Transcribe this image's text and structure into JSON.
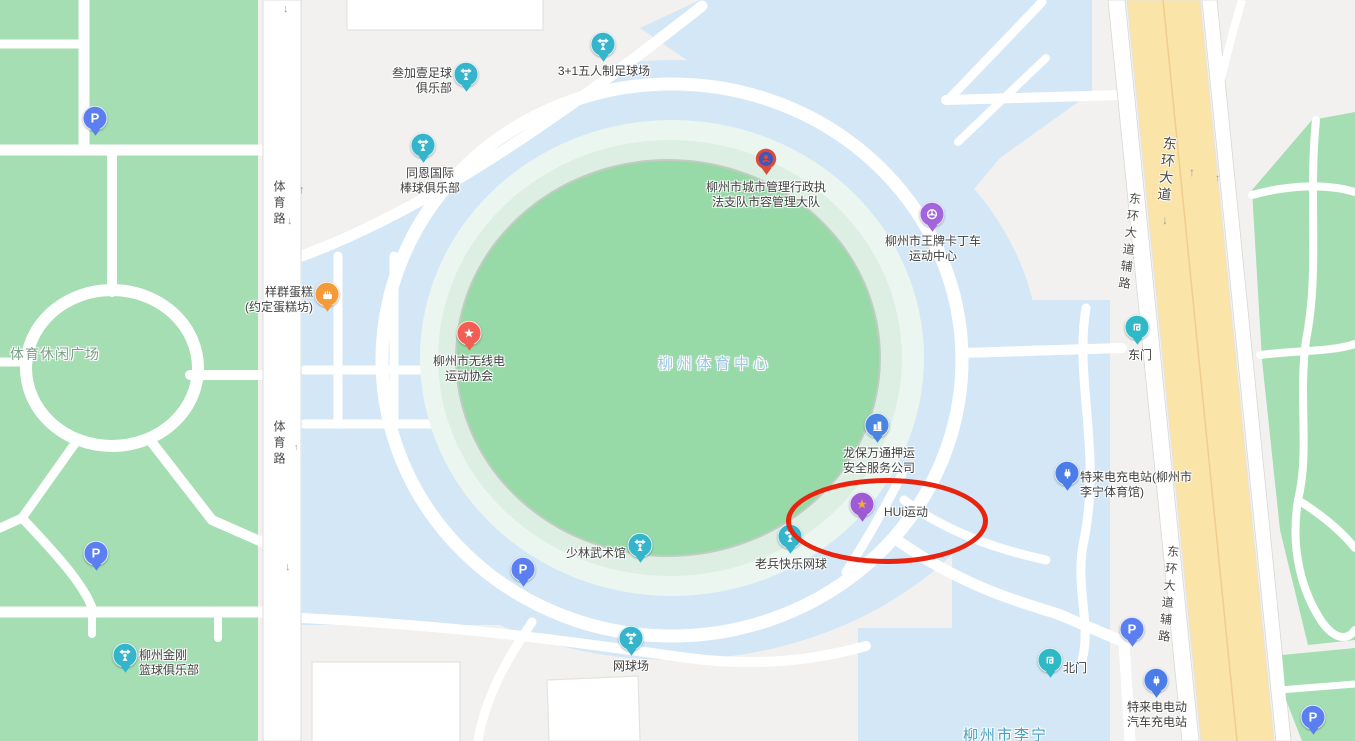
{
  "map": {
    "colors": {
      "background": "#f2f1ef",
      "park_green": "#a4deb2",
      "grounds_blue": "#d3e7f6",
      "stadium_green": "#98d9a8",
      "stadium_ring_mint": "#ecf6f0",
      "stadium_ring_pale": "#ddefe3",
      "road_white": "#ffffff",
      "avenue_yellow": "#fbe4a7",
      "annotation_red": "#e8230f",
      "pin_sport": "#35b5cb",
      "pin_kart": "#a265dc",
      "pin_hui": "#9d5bd6",
      "pin_star": "#f25e54",
      "pin_cake": "#f59a38",
      "pin_building": "#4a86e0",
      "pin_charging": "#4a7de8",
      "pin_gate": "#2fb8c5",
      "pin_parking": "#5b7ff0",
      "pin_gov": "#db4a3a",
      "hui_star": "#f7a63c"
    },
    "area_labels": [
      {
        "id": "sports-leisure-plaza",
        "text": "体育休闲广场",
        "x": 10,
        "y": 344,
        "size": 14,
        "color": "#7b9f86",
        "ls": 1,
        "center": false
      },
      {
        "id": "liuzhou-sports-center",
        "text": "柳州体育中心",
        "x": 715,
        "y": 363,
        "size": 15,
        "color": "#9cc5e2",
        "ls": 4,
        "center": true
      },
      {
        "id": "liuzhou-lining",
        "text": "柳州市李宁",
        "x": 963,
        "y": 724,
        "size": 15,
        "color": "#43a0bf",
        "ls": 2,
        "center": false
      }
    ],
    "road_labels": [
      {
        "id": "tiyu-road-north",
        "text": "体育路",
        "x": 271,
        "y": 180,
        "size": 12,
        "rot": 0,
        "ls": 4
      },
      {
        "id": "tiyu-road-south",
        "text": "体育路",
        "x": 271,
        "y": 420,
        "size": 12,
        "rot": 0,
        "ls": 4
      },
      {
        "id": "donghuan-avenue",
        "text": "东环大道",
        "x": 1157,
        "y": 136,
        "size": 14,
        "rot": 6,
        "ls": 3
      },
      {
        "id": "donghuan-frontage-west",
        "text": "东环大道辅路",
        "x": 1121,
        "y": 192,
        "size": 12,
        "rot": 7,
        "ls": 5
      },
      {
        "id": "donghuan-frontage-east",
        "text": "东环大道辅路",
        "x": 1160,
        "y": 545,
        "size": 12,
        "rot": 6,
        "ls": 5
      }
    ],
    "direction_arrows": [
      {
        "glyph": "↓",
        "x": 283,
        "y": 4,
        "size": 11
      },
      {
        "glyph": "↑",
        "x": 299,
        "y": 185,
        "size": 11
      },
      {
        "glyph": "↓",
        "x": 287,
        "y": 216,
        "size": 11
      },
      {
        "glyph": "↑",
        "x": 294,
        "y": 443,
        "size": 9
      },
      {
        "glyph": "↓",
        "x": 285,
        "y": 562,
        "size": 11
      },
      {
        "glyph": "↑",
        "x": 1189,
        "y": 166,
        "size": 12
      },
      {
        "glyph": "↓",
        "x": 1162,
        "y": 214,
        "size": 12
      },
      {
        "glyph": "↑",
        "x": 1215,
        "y": 174,
        "size": 10
      }
    ],
    "pois": [
      {
        "id": "sanjiayi-football-club",
        "type": "sport",
        "x": 466,
        "y": 82,
        "label": "叁加壹足球\n俱乐部",
        "lx": 452,
        "ly": 66,
        "align": "right"
      },
      {
        "id": "five-a-side-pitch",
        "type": "sport",
        "x": 603,
        "y": 52,
        "label": "3+1五人制足球场",
        "lx": 604,
        "ly": 64,
        "align": "center"
      },
      {
        "id": "tongen-baseball-club",
        "type": "sport",
        "x": 423,
        "y": 153,
        "label": "同恩国际\n棒球俱乐部",
        "lx": 430,
        "ly": 166,
        "align": "center"
      },
      {
        "id": "city-mgmt-enforcement-brigade",
        "type": "gov",
        "x": 766,
        "y": 166,
        "label": "柳州市城市管理行政执\n法支队市容管理大队",
        "lx": 766,
        "ly": 180,
        "align": "center"
      },
      {
        "id": "wangpai-karting-center",
        "type": "kart",
        "x": 932,
        "y": 222,
        "label": "柳州市王牌卡丁车\n运动中心",
        "lx": 933,
        "ly": 234,
        "align": "center"
      },
      {
        "id": "yangqun-cake-shop",
        "type": "cake",
        "x": 327,
        "y": 302,
        "label": "样群蛋糕\n(约定蛋糕坊)",
        "lx": 313,
        "ly": 285,
        "align": "right"
      },
      {
        "id": "radio-sports-association",
        "type": "star",
        "x": 469,
        "y": 341,
        "label": "柳州市无线电\n运动协会",
        "lx": 469,
        "ly": 354,
        "align": "center"
      },
      {
        "id": "longbao-escort-company",
        "type": "building",
        "x": 877,
        "y": 433,
        "label": "龙保万通押运\n安全服务公司",
        "lx": 879,
        "ly": 446,
        "align": "center"
      },
      {
        "id": "hui-sports",
        "type": "hui",
        "x": 862,
        "y": 512,
        "label": "HUi运动",
        "lx": 884,
        "ly": 505,
        "align": "left"
      },
      {
        "id": "shaolin-martial-arts-hall",
        "type": "sport",
        "x": 640,
        "y": 553,
        "label": "少林武术馆",
        "lx": 626,
        "ly": 546,
        "align": "right"
      },
      {
        "id": "laobing-happy-tennis",
        "type": "sport",
        "x": 790,
        "y": 544,
        "label": "老兵快乐网球",
        "lx": 791,
        "ly": 557,
        "align": "center"
      },
      {
        "id": "tennis-court",
        "type": "sport",
        "x": 631,
        "y": 646,
        "label": "网球场",
        "lx": 631,
        "ly": 659,
        "align": "center"
      },
      {
        "id": "east-gate",
        "type": "gate",
        "x": 1137,
        "y": 335,
        "label": "东门",
        "lx": 1140,
        "ly": 348,
        "align": "center"
      },
      {
        "id": "teld-charging-lining-gym",
        "type": "charging",
        "x": 1067,
        "y": 481,
        "label": "特来电充电站(柳州市\n李宁体育馆)",
        "lx": 1080,
        "ly": 470,
        "align": "left"
      },
      {
        "id": "north-gate",
        "type": "gate",
        "x": 1050,
        "y": 668,
        "label": "北门",
        "lx": 1063,
        "ly": 661,
        "align": "left"
      },
      {
        "id": "teld-ev-charging",
        "type": "charging",
        "x": 1156,
        "y": 688,
        "label": "特来电电动\n汽车充电站",
        "lx": 1157,
        "ly": 700,
        "align": "center"
      },
      {
        "id": "jingang-basketball-club",
        "type": "sport",
        "x": 125,
        "y": 663,
        "label": "柳州金刚\n篮球俱乐部",
        "lx": 139,
        "ly": 648,
        "align": "left"
      },
      {
        "id": "parking-northwest",
        "type": "parking",
        "x": 95,
        "y": 126
      },
      {
        "id": "parking-southwest",
        "type": "parking",
        "x": 96,
        "y": 561
      },
      {
        "id": "parking-inner",
        "type": "parking",
        "x": 523,
        "y": 577
      },
      {
        "id": "parking-east",
        "type": "parking",
        "x": 1132,
        "y": 637
      },
      {
        "id": "parking-southeast",
        "type": "parking",
        "x": 1313,
        "y": 725
      }
    ],
    "annotation": {
      "shape": "ellipse",
      "x": 786,
      "y": 478,
      "width": 192,
      "height": 76,
      "color": "#e8230f",
      "stroke_width": 5
    }
  }
}
